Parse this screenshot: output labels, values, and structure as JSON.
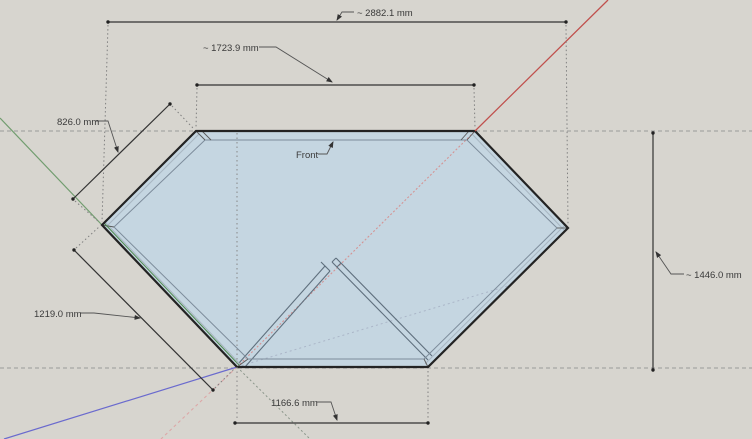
{
  "labels": {
    "front": "Front"
  },
  "dimensions": {
    "top_width": "~ 2882.1 mm",
    "front_edge": "~ 1723.9 mm",
    "upper_left_edge": "826.0 mm",
    "lower_left_edge": "1219.0 mm",
    "bottom_edge": "1166.6 mm",
    "right_height": "~ 1446.0 mm"
  },
  "colors": {
    "background": "#d7d5cf",
    "face_fill": "#c5d6e1",
    "edge": "#232323",
    "red_axis": "#c0504d",
    "red_axis_hidden": "#d49494",
    "green_axis": "#4f8a4f",
    "blue_axis": "#6a6ace",
    "guide": "#9a9a9a",
    "dimension_text": "#3a3a3a"
  }
}
